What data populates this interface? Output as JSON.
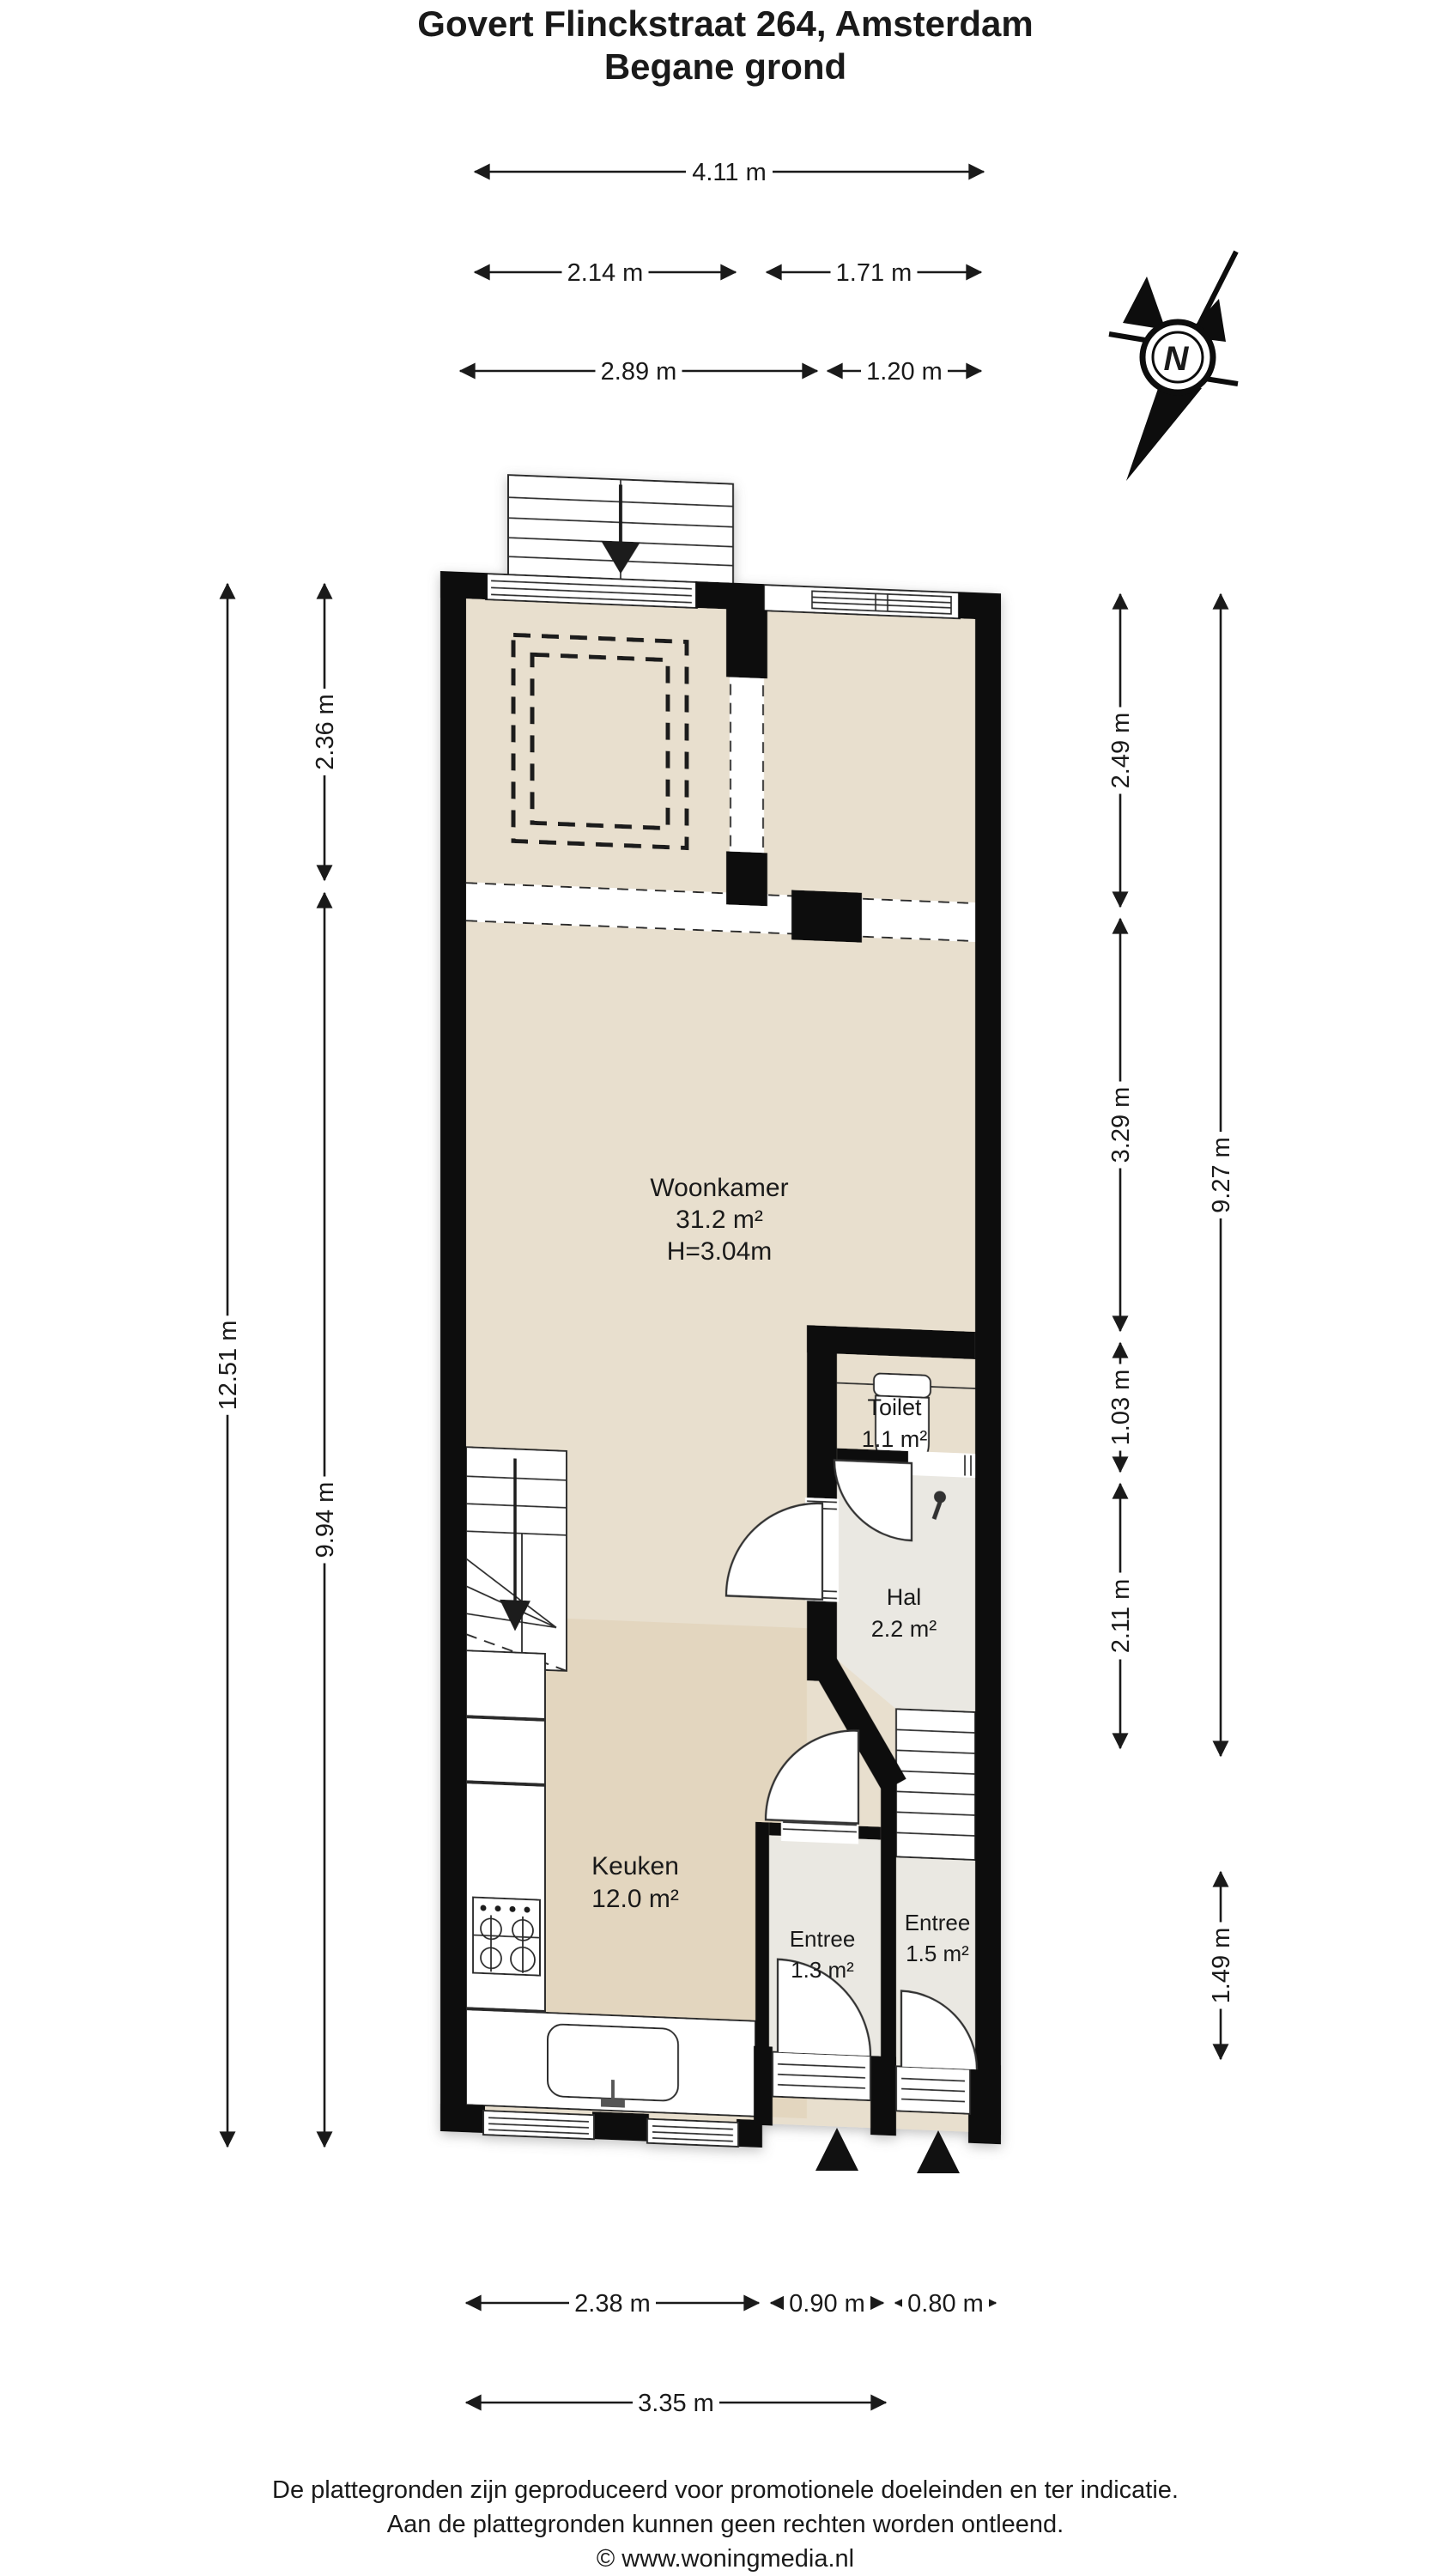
{
  "title": {
    "line1": "Govert Flinckstraat 264, Amsterdam",
    "line2": "Begane grond"
  },
  "compass": {
    "north_label": "N"
  },
  "rooms": {
    "woonkamer": {
      "name": "Woonkamer",
      "area": "31.2 m²",
      "height": "H=3.04m"
    },
    "toilet": {
      "name": "Toilet",
      "area": "1.1 m²"
    },
    "hal": {
      "name": "Hal",
      "area": "2.2 m²"
    },
    "keuken": {
      "name": "Keuken",
      "area": "12.0 m²"
    },
    "entree_links": {
      "name": "Entree",
      "area": "1.3 m²"
    },
    "entree_rechts": {
      "name": "Entree",
      "area": "1.5 m²"
    }
  },
  "dimensions": {
    "top_total": "4.11 m",
    "top_left_room": "2.14 m",
    "top_right_room": "1.71 m",
    "top_woonkamer": "2.89 m",
    "top_toilet_strook": "1.20 m",
    "left_total": "12.51 m",
    "left_front": "2.36 m",
    "left_main": "9.94 m",
    "right_front": "2.49 m",
    "right_woonkamer": "3.29 m",
    "right_toilet": "1.03 m",
    "right_hal": "2.11 m",
    "right_total": "9.27 m",
    "right_entree": "1.49 m",
    "bottom_keuken": "2.38 m",
    "bottom_entree_links": "0.90 m",
    "bottom_entree_rechts": "0.80 m",
    "bottom_total": "3.35 m"
  },
  "footer": {
    "line1": "De plattegronden zijn geproduceerd voor promotionele doeleinden en ter indicatie.",
    "line2": "Aan de plattegronden kunnen geen rechten worden ontleend.",
    "line3": "© www.woningmedia.nl"
  },
  "colors": {
    "wall": "#0d0d0d",
    "floor_beige": "#e8dfce",
    "floor_keuken": "#e3d6bf",
    "floor_gray": "#eae8e2"
  }
}
